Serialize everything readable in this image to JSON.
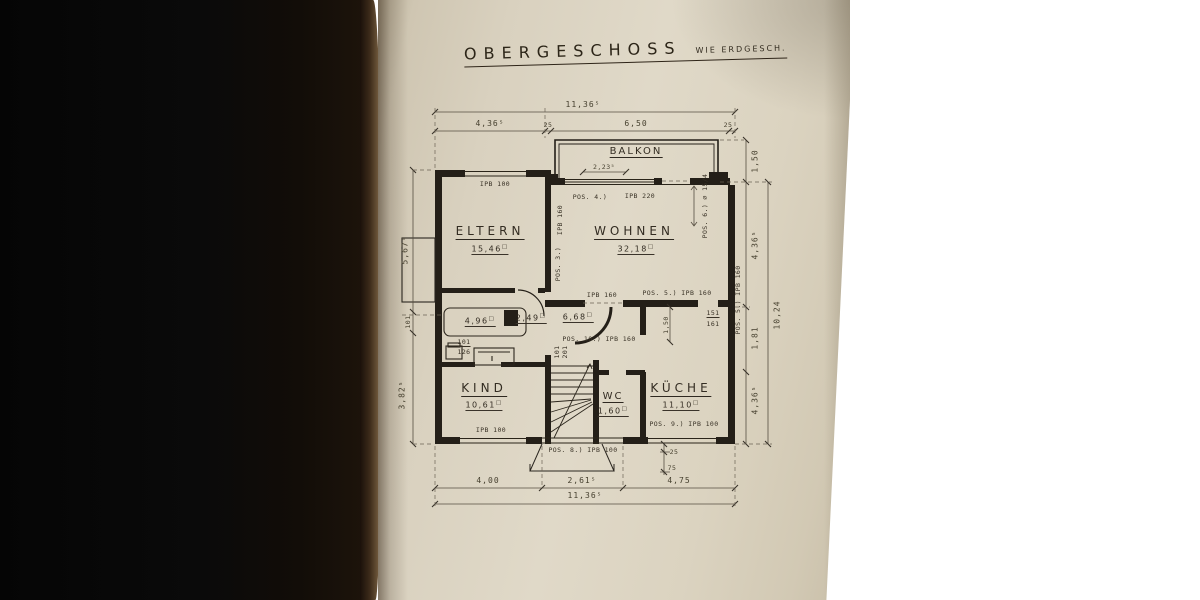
{
  "title": {
    "main": "OBERGESCHOSS",
    "sub": "WIE ERDGESCH."
  },
  "glyphs": {
    "sq": "□"
  },
  "rooms": {
    "balkon": {
      "label": "BALKON"
    },
    "eltern": {
      "label": "ELTERN",
      "area": "15,46"
    },
    "wohnen": {
      "label": "WOHNEN",
      "area": "32,18"
    },
    "bad": {
      "area": "4,96"
    },
    "vorraum": {
      "area": "2,49"
    },
    "flur": {
      "area": "6,68"
    },
    "kind": {
      "label": "KIND",
      "area": "10,61"
    },
    "wc": {
      "label": "WC",
      "area": "1,60"
    },
    "kueche": {
      "label": "KÜCHE",
      "area": "11,10"
    }
  },
  "dims": {
    "top_total": "11,36⁵",
    "top_left": "4,36⁵",
    "top_wall": "25",
    "top_right": "6,50",
    "top_wall2": "25",
    "bottom_left": "4,00",
    "bottom_mid": "2,61⁵",
    "bottom_right": "4,75",
    "bottom_total": "11,36⁵",
    "right_balcony": "1,50",
    "right_upper": "4,36⁵",
    "right_mid": "1,81",
    "right_total": "10,24",
    "right_lower": "4,36⁵",
    "left_upper": "5,67⁵",
    "left_door": "101",
    "left_lower": "3,82⁵",
    "balkon_width": "2,23⁵",
    "mid_height": "1,50",
    "door_a1": "101",
    "door_a2": "126",
    "door_b1": "101",
    "door_b2": "201",
    "door_c1": "151",
    "door_c2": "161",
    "small_1": "25",
    "small_2": "75"
  },
  "beams": {
    "eltern_window": "IPB 100",
    "balkon_beam": "IPB 220",
    "pos4": "POS. 4.)",
    "pos6": "POS. 6.) ∅ 15/4",
    "pos3": "POS. 3.)",
    "wohnen_left_beam": "IPB 160",
    "mid_beam": "IPB 160",
    "pos5a": "POS. 5.) IPB 160",
    "pos5b": "POS. 5.) IPB 160",
    "pos10": "POS. 10.) IPB 160",
    "kind_window": "IPB 100",
    "pos8": "POS. 8.) IPB 100",
    "pos9": "POS. 9.) IPB 100"
  }
}
